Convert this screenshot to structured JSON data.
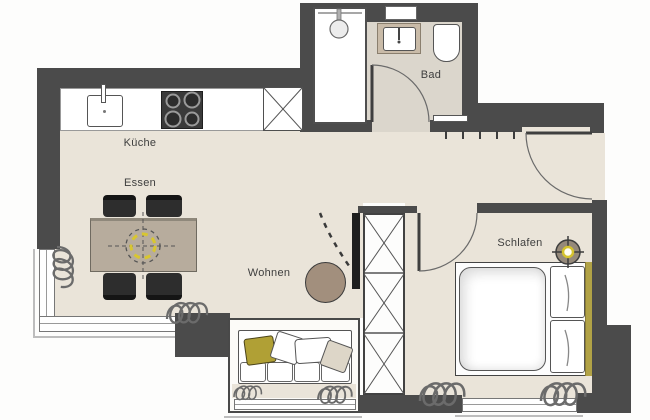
{
  "meta": {
    "type": "apartment-floor-plan",
    "style": "top-down architectural drawing"
  },
  "rooms": {
    "kueche": {
      "label": "Küche"
    },
    "essen": {
      "label": "Essen"
    },
    "wohnen": {
      "label": "Wohnen"
    },
    "bad": {
      "label": "Bad"
    },
    "schlafen": {
      "label": "Schlafen"
    }
  },
  "fixtures": [
    "kitchen-counter",
    "kitchen-sink",
    "stove-4-burners",
    "tall-cabinet-x-symbol",
    "shower",
    "shower-head",
    "bath-vanity",
    "wash-basin",
    "toilet",
    "bath-mat",
    "coat-hooks",
    "entry-door-arc",
    "bath-door-arc",
    "bedroom-door-arc",
    "dining-table",
    "four-chairs",
    "pendant-lamp-dashed-symbol",
    "sofa-in-bay",
    "pillows",
    "round-side-table",
    "tv-panel",
    "wardrobe-x-column",
    "double-bed",
    "headboard",
    "ceiling-lamp-symbol",
    "radiator-squiggles",
    "corner-window",
    "bay-window",
    "bedroom-window"
  ],
  "colors": {
    "wall": "#4b4b4b",
    "floor": "#eae4d9",
    "bath_floor": "#dbd6cc",
    "outline": "#3c3c3c",
    "accent_yellow": "#d8c630",
    "olive_textile": "#b0a035",
    "headboard_olive": "#b1a246",
    "table_taupe": "#b7ac9d",
    "pouf_taupe": "#a28f7d",
    "chair_dark": "#2d2d2d"
  }
}
